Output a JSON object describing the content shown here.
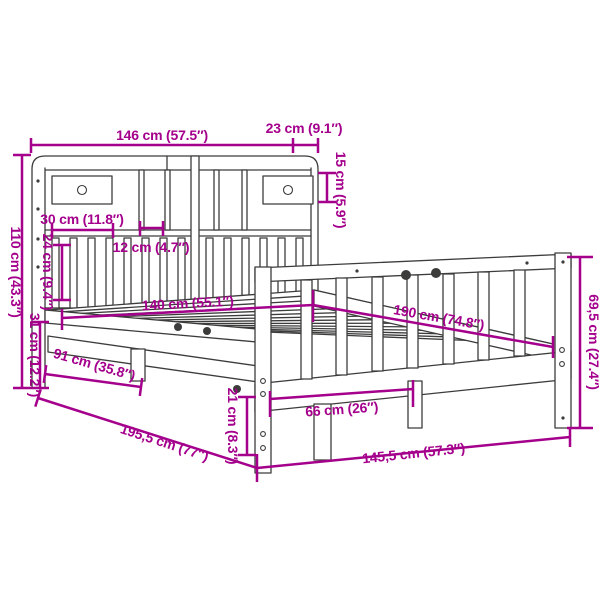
{
  "diagram": {
    "kind": "furniture-dimension-diagram",
    "subject": "bookcase bed with storage headboard, drawers and slatted frame",
    "background_color": "#FFFFFF",
    "line_art_color": "#3C3C3B",
    "dimension_color": "#A4008C",
    "units": [
      "cm",
      "inch"
    ]
  },
  "dims": {
    "d146": "146 cm (57.5″)",
    "d23": "23 cm (9.1″)",
    "d15": "15 cm (5.9″)",
    "d110": "110 cm (43.3″)",
    "d30": "30 cm (11.8″)",
    "d12": "12 cm (4.7″)",
    "d24": "24 cm (9.4″)",
    "d31": "31 cm (12.2″)",
    "d140": "140 cm (55.1″)",
    "d190": "190 cm (74.8″)",
    "d69_5": "69,5 cm (27.4″)",
    "d91": "91 cm (35.8″)",
    "d195_5": "195,5 cm (77″)",
    "d21": "21 cm (8.3″)",
    "d66": "66 cm (26″)",
    "d145_5": "145,5 cm (57.3″)"
  }
}
